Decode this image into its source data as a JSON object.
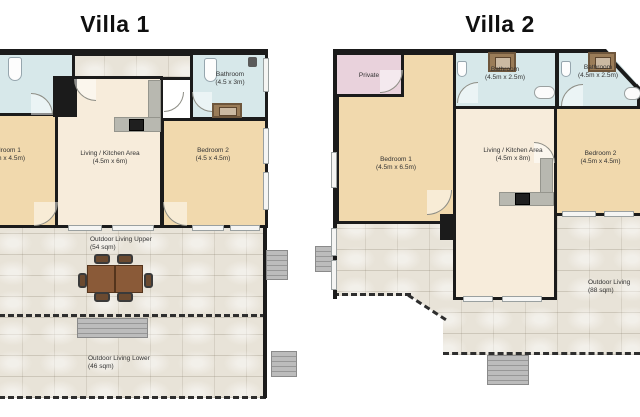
{
  "villa1": {
    "title": "Villa 1",
    "rooms": {
      "bathroom": {
        "name": "Bathroom",
        "dims": "(4.5 x 3m)"
      },
      "bedroom1": {
        "name": "Bedroom 1",
        "dims": "(4.5m x 4.5m)"
      },
      "living": {
        "name": "Living / Kitchen Area",
        "dims": "(4.5m x 6m)"
      },
      "bedroom2": {
        "name": "Bedroom 2",
        "dims": "(4.5 x 4.5m)"
      },
      "outdoor_upper": {
        "name": "Outdoor Living Upper",
        "dims": "(54 sqm)"
      },
      "outdoor_lower": {
        "name": "Outdoor Living Lower",
        "dims": "(46 sqm)"
      }
    }
  },
  "villa2": {
    "title": "Villa 2",
    "rooms": {
      "private": {
        "name": "Private"
      },
      "bathroom1": {
        "name": "Bathroom",
        "dims": "(4.5m x 2.5m)"
      },
      "bathroom2": {
        "name": "Bathroom",
        "dims": "(4.5m x 2.5m)"
      },
      "bedroom1": {
        "name": "Bedroom 1",
        "dims": "(4.5m x 6.5m)"
      },
      "living": {
        "name": "Living / Kitchen Area",
        "dims": "(4.5m x 8m)"
      },
      "bedroom2": {
        "name": "Bedroom 2",
        "dims": "(4.5m x 4.5m)"
      },
      "outdoor": {
        "name": "Outdoor Living",
        "dims": "(88 sqm)"
      }
    }
  },
  "colors": {
    "wall": "#1b1b1b",
    "bedroom": "#f1d9ad",
    "living": "#f7ecdb",
    "bathroom": "#d7e8ea",
    "private": "#e9d2dc",
    "stone": "#e8e3d8",
    "counter": "#b8b8b0",
    "stove": "#1f1f1f",
    "table": "#8a5a38",
    "stairs": "#b5b5b5"
  }
}
